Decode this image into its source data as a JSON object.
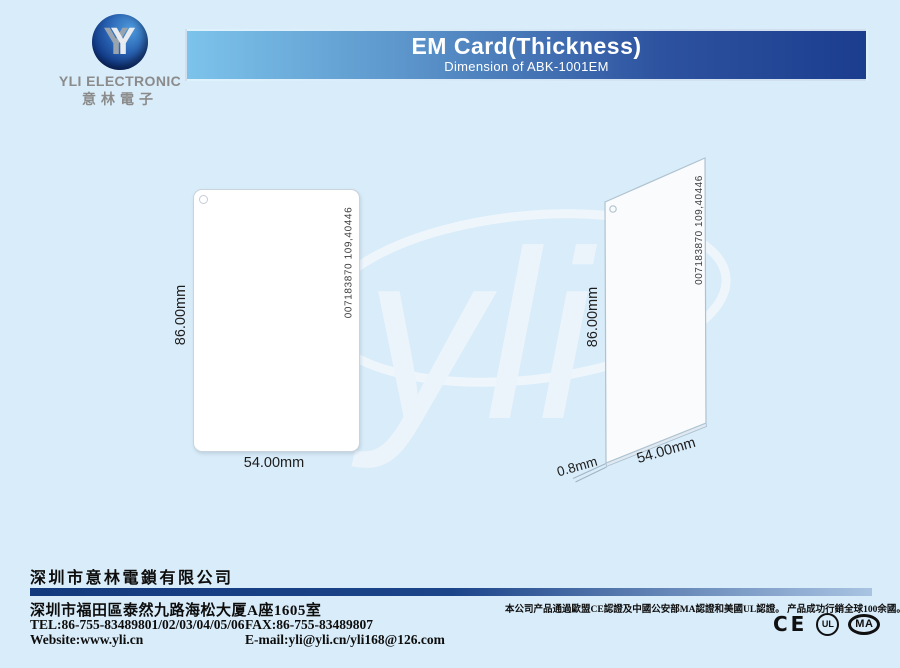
{
  "logo": {
    "monogram": "Y",
    "company": "YLI ELECTRONIC",
    "company_cn": "意林電子"
  },
  "header": {
    "title": "EM Card(Thickness)",
    "subtitle": "Dimension of ABK-1001EM",
    "gradient_left": "#7cc3eb",
    "gradient_right": "#1c3d8e"
  },
  "watermark": {
    "text": "yli"
  },
  "figures": {
    "front": {
      "height_label": "86.00mm",
      "width_label": "54.00mm",
      "card_number": "007183870 109,40446"
    },
    "side": {
      "height_label": "86.00mm",
      "width_label": "54.00mm",
      "thickness_label": "0.8mm",
      "card_number": "007183870 109,40446"
    }
  },
  "footer": {
    "company_cn": "深圳市意林電鎖有限公司",
    "address_cn": "深圳市福田區泰然九路海松大厦A座1605室",
    "tel": "TEL:86-755-83489801/02/03/04/05/06",
    "fax": "FAX:86-755-83489807",
    "website": "Website:www.yli.cn",
    "email": "E-mail:yli@yli.cn/yli168@126.com",
    "certification_note": "本公司产品通過歐盟CE認證及中國公安部MA認證和美國UL認證。 产品成功行銷全球100余國。",
    "marks": {
      "ce": "CE",
      "ul": "UL",
      "ma": "MA"
    },
    "bar_color_left": "#143a7e",
    "bar_color_right": "#a9c4e2"
  }
}
